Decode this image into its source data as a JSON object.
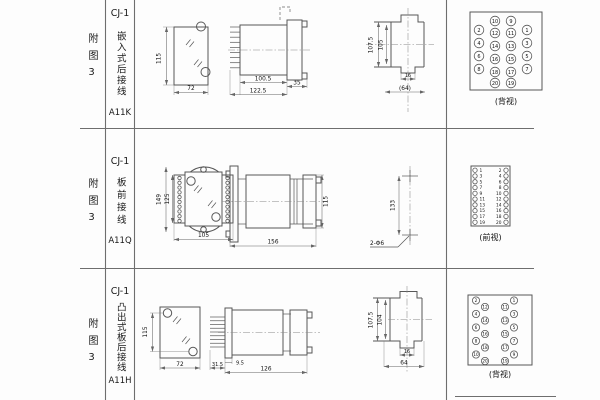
{
  "rows": [
    {
      "fig": "附图3",
      "model": "CJ-1",
      "type": "嵌入式后接线",
      "code": "A11K",
      "dims": {
        "height": "115",
        "width": "72",
        "body_len": "100.5",
        "total_len": "122.5",
        "flange": "35",
        "cutout_outer": "107.5",
        "cutout_inner": "105",
        "foot": "16",
        "ref_width": "(64)"
      },
      "terminal": {
        "label": "(背视)",
        "grid": [
          [
            "",
            "10",
            "9",
            ""
          ],
          [
            "2",
            "12",
            "11",
            "1"
          ],
          [
            "4",
            "14",
            "13",
            "3"
          ],
          [
            "6",
            "16",
            "15",
            "5"
          ],
          [
            "8",
            "18",
            "17",
            "7"
          ],
          [
            "",
            "20",
            "19",
            ""
          ]
        ]
      }
    },
    {
      "fig": "附图3",
      "model": "CJ-1",
      "type": "板前接线",
      "code": "A11Q",
      "dims": {
        "outer_h": "149",
        "inner_h": "125",
        "width": "105",
        "length": "156",
        "height": "115",
        "hole_span": "133",
        "hole_note": "2-Φ6"
      },
      "terminal": {
        "label": "(前视)",
        "left": [
          "1",
          "3",
          "5",
          "7",
          "9",
          "11",
          "13",
          "15",
          "17",
          "19"
        ],
        "right": [
          "2",
          "4",
          "6",
          "8",
          "10",
          "12",
          "14",
          "16",
          "18",
          "20"
        ]
      }
    },
    {
      "fig": "附图3",
      "model": "CJ-1",
      "type": "凸出式板后接线",
      "code": "A11H",
      "dims": {
        "height": "115",
        "width": "72",
        "pin_len": "31.5",
        "flange": "9.5",
        "length": "126",
        "outer": "107.5",
        "inner": "104",
        "foot": "16",
        "base_w": "64"
      },
      "terminal": {
        "label": "(背视)",
        "left_outer": [
          "2",
          "4",
          "6",
          "8",
          "10"
        ],
        "left_inner": [
          "12",
          "14",
          "16",
          "18",
          "20"
        ],
        "right_inner": [
          "11",
          "13",
          "15",
          "17",
          "19"
        ],
        "right_outer": [
          "1",
          "3",
          "5",
          "7",
          "9"
        ]
      }
    }
  ]
}
